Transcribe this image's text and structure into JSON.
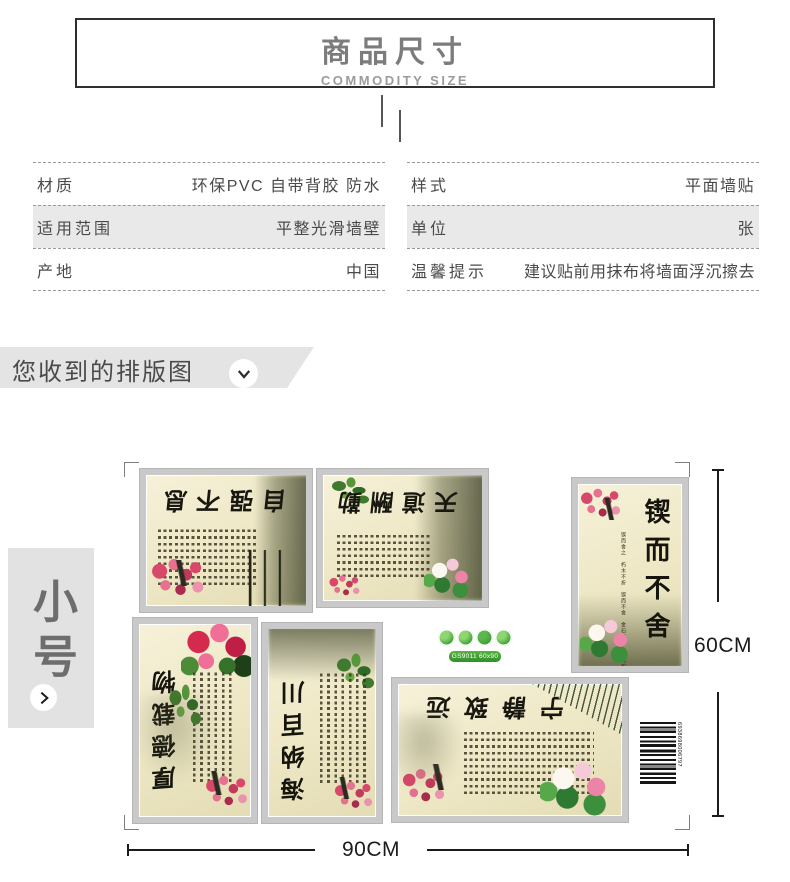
{
  "header": {
    "title": "商品尺寸",
    "subtitle": "COMMODITY SIZE"
  },
  "specs": {
    "left": [
      {
        "label": "材质",
        "value": "环保PVC 自带背胶 防水"
      },
      {
        "label": "适用范围",
        "value": "平整光滑墙壁"
      },
      {
        "label": "产地",
        "value": "中国"
      }
    ],
    "right": [
      {
        "label": "样式",
        "value": "平面墙贴"
      },
      {
        "label": "单位",
        "value": "张"
      },
      {
        "label": "温馨提示",
        "value": "建议贴前用抹布将墙面浮沉擦去"
      }
    ]
  },
  "section": {
    "title": "您收到的排版图"
  },
  "size_tag": {
    "label": "小号"
  },
  "figure": {
    "width_label": "90CM",
    "height_label": "60CM",
    "eco_label": "GS9011 60x90",
    "barcode_number": "6938698006797",
    "posters": [
      {
        "calligraphy": "自强不息"
      },
      {
        "calligraphy": "天道酬勤"
      },
      {
        "calligraphy": "锲而不舍",
        "quote": "锲而舍之 朽木不折 锲而不舍 金石可镂 学习和实践过程中无论遇到什么困难 只要坚定目标不灰心丧气 不轻易改变自己决定的目标 因此才会有所成就 而达到自己的目的"
      },
      {
        "calligraphy": "厚德载物"
      },
      {
        "calligraphy": "海纳百川"
      },
      {
        "calligraphy": "宁静致远"
      }
    ]
  },
  "colors": {
    "accent_green": "#3a9b32",
    "frame_gray": "#c9c9c9",
    "banner_gray": "#e4e4e4",
    "row_gray": "#e9e9e9",
    "text_dark": "#4a4a4a"
  }
}
